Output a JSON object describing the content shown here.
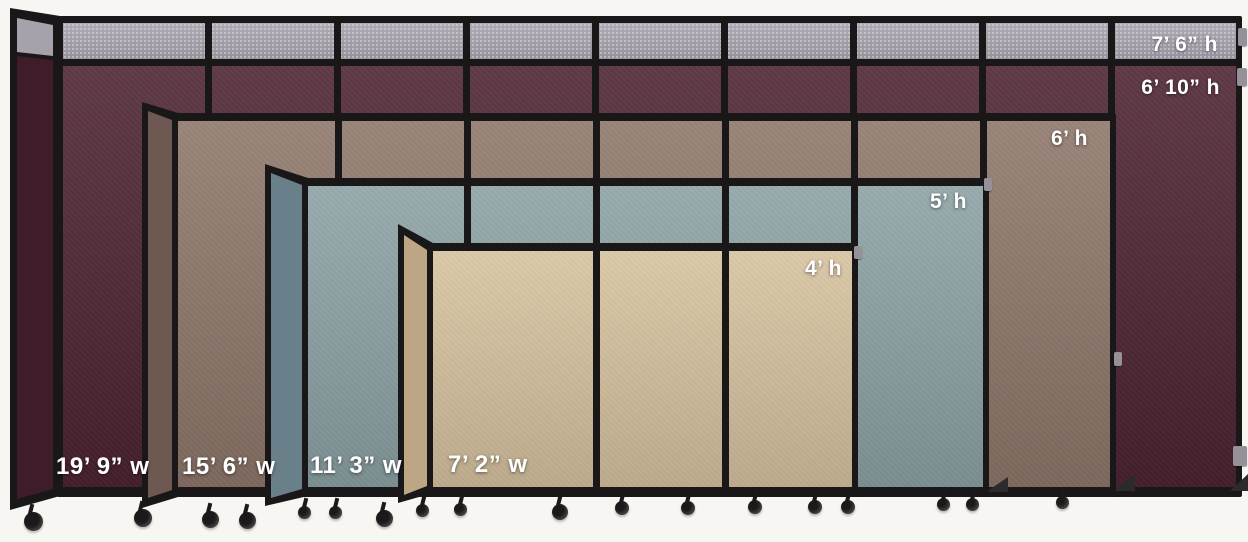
{
  "colors": {
    "background": "#f7f6f3",
    "frame": "#1a1718",
    "topper_gray": "#a7a1ac",
    "maroon": "#4c2231",
    "maroon_dark": "#3f1c2a",
    "brown": "#8d7669",
    "brown_dark": "#6d5951",
    "blue": "#8ba1a4",
    "blue_dark": "#69808a",
    "beige": "#d6c29e",
    "beige_dark": "#bca684",
    "label_text": "#ffffff",
    "caster": "#1b1919",
    "hinge": "#969198"
  },
  "partitions": [
    {
      "id": "maroon",
      "panel_count": 9,
      "has_topper": true,
      "width_label": "19’ 9” w",
      "height_label_extended": "7’ 6” h",
      "height_label": "6’ 10” h"
    },
    {
      "id": "brown",
      "panel_count": 7,
      "has_topper": false,
      "width_label": "15’ 6” w",
      "height_label": "6’ h"
    },
    {
      "id": "blue",
      "panel_count": 5,
      "has_topper": false,
      "width_label": "11’ 3” w",
      "height_label": "5’ h"
    },
    {
      "id": "beige",
      "panel_count": 3,
      "has_topper": false,
      "width_label": "7’ 2” w",
      "height_label": "4’ h"
    }
  ]
}
